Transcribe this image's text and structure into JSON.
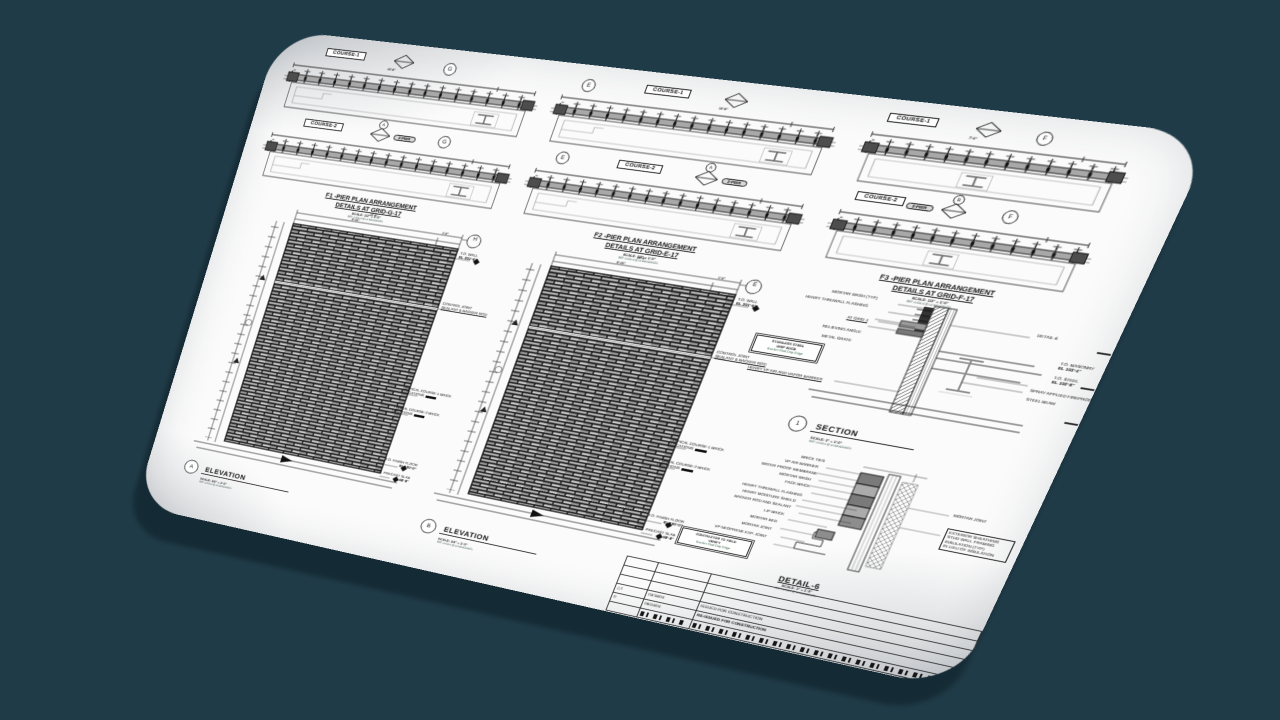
{
  "canvas": {
    "background": "#1f3b47",
    "shadow": "#142a34",
    "sheet": "#fbfbfb"
  },
  "plans": [
    {
      "course1_label": "COURSE-1",
      "course2_label": "COURSE-2",
      "grid_bubble": "G",
      "detail_bubble": "A",
      "pier_tag": "2-PIER",
      "dim_total": "10'-8\"",
      "title_line1": "F1 -PIER PLAN ARRANGEMENT",
      "title_line2": "DETAILS AT GRID-G-17",
      "scale_note": "SCALE: 1/2\" = 1'-0\"",
      "ref_note": "REF: A-510.4 @ LA MANZANITA"
    },
    {
      "course1_label": "COURSE-1",
      "course2_label": "COURSE-2",
      "grid_bubble": "E",
      "detail_bubble": "A",
      "pier_tag": "2-PIER",
      "dim_total": "10'-8\"",
      "title_line1": "F2 -PIER PLAN ARRANGEMENT",
      "title_line2": "DETAILS AT GRID-E-17",
      "scale_note": "SCALE: 1/2\" = 1'-0\"",
      "ref_note": "REF: A-510.4 @ LA MANZANITA"
    },
    {
      "course1_label": "COURSE-1",
      "course2_label": "COURSE-2",
      "grid_bubble": "F",
      "detail_bubble": "B",
      "pier_tag": "2-PIER",
      "dim_total": "7'-0\"",
      "title_line1": "F3 -PIER PLAN ARRANGEMENT",
      "title_line2": "DETAILS AT GRID-F-17",
      "scale_note": "SCALE: 1/2\" = 1'-0\"",
      "ref_note": "REF: A-510.4 @ LA MANZANITA"
    }
  ],
  "elevations": [
    {
      "title_bubble": "A",
      "title": "ELEVATION",
      "scale_note": "SCALE: 1/4\" = 1'-0\"",
      "ref_note": "REF: A-510.4 @ LA MANZANITA",
      "grid_bubble": "H",
      "dim_total": "10'-8\"",
      "dim_main": "9'-10\"",
      "dim_end": "1'-0\"",
      "callouts": {
        "wall_l1": "T.O. WALL",
        "wall_l2": "EL 301'-6\"",
        "cj_l1": "CONTROL JOINT",
        "cj_l2": "SEALANT & BACKER ROD",
        "c1_l1": "TYPICAL COURSE-1 BRICK",
        "c1_l2": "LOCATIONS",
        "c2_l1": "TYPICAL COURSE-2 BRICK",
        "c2_l2": "LOCATIONS",
        "ff_l1": "T.O. FINISH FLOOR",
        "ff_l2": "EL 100'-0\"",
        "ps_l1": "T.O. PRECAST SLAB",
        "ps_l2": "EL 98'-8\""
      }
    },
    {
      "title_bubble": "B",
      "title": "ELEVATION",
      "scale_note": "SCALE: 1/4\" = 1'-0\"",
      "ref_note": "REF: A-510.4 @ LA MANZANITA",
      "grid_bubble": "E",
      "dim_total": "10'-8\"",
      "dim_main": "9'-10\"",
      "dim_end": "1'-0\"",
      "callouts": {
        "wall_l1": "T.O. WALL",
        "wall_l2": "EL 301'-6\"",
        "cj_l1": "CONTROL JOINT",
        "cj_l2": "SEALANT & BACKER ROD",
        "c1_l1": "TYPICAL COURSE-1 BRICK",
        "c1_l2": "LOCATIONS",
        "c2_l1": "TYPICAL COURSE-2 BRICK",
        "c2_l2": "LOCATIONS",
        "ff_l1": "T.O. FINISH FLOOR",
        "ff_l2": "EL 100'-0\"",
        "ps_l1": "T.O. PRECAST SLAB",
        "ps_l2": "EL 98'-8\""
      }
    }
  ],
  "section": {
    "title_bubble": "1",
    "title": "SECTION",
    "scale_note": "SCALE: 3\" = 1'-0\"",
    "ref_note": "REF: A-510.4 @ LA MANZANITA",
    "left_callouts": [
      "MORTAR WASH (TYP)",
      "HENRY THRUWALL FLASHING",
      "AT GRID 4",
      "RELIEVING ANGLE",
      "METAL GRATE",
      "HENRY VP AIR AND VAPOR BARRIER"
    ],
    "note_box": [
      "STAINLESS STEEL",
      "DRIP EDGE",
      "Backer Rod Drip Edge"
    ],
    "right_callouts": [
      "DETAIL-6",
      "T.O. MASONRY",
      "EL 103'-4\"",
      "T.O. STEEL",
      "EL 102'-8\"",
      "SPRAY APPLIED FIREPROOFING MATERIAL",
      "STEEL BEAM"
    ]
  },
  "detail": {
    "title": "DETAIL-6",
    "scale_note": "SCALE: 3\" = 1'-0\"",
    "ref_note": "REF: A-510.4 @ LA MANZANITA",
    "left_callouts": [
      "BRICK TIES",
      "VP AIR BARRIER",
      "WATER PROOF MEMBRANE",
      "MORTAR WASH",
      "FACE BRICK",
      "HENRY THRUWALL FLASHING",
      "HENRY MOISTURE SHIELD",
      "BACKER ROD AND SEALANT",
      "LIP BRICK",
      "MORTAR BED",
      "MORTAR JOINT",
      "VP NEOPRENE EXP. JOINT"
    ],
    "right_callouts": [
      "MORTAR JOINT",
      "EXTERIOR SHEATHING",
      "STUD WALL FRAMING",
      "INSULATION (TYP)",
      "IN LIEU OF INSULATION"
    ],
    "note_box": [
      "CONTRACTOR TO FIELD",
      "VERIFY",
      "Backer Rod Drip Edge"
    ]
  },
  "titleblock": {
    "rows": [
      {
        "sym": "△1",
        "date": "03/18/04",
        "desc": "ISSUED FOR CONSTRUCTION"
      },
      {
        "sym": "0",
        "date": "06/23/04",
        "desc": "RE-ISSUED FOR CONSTRUCTION"
      }
    ]
  }
}
